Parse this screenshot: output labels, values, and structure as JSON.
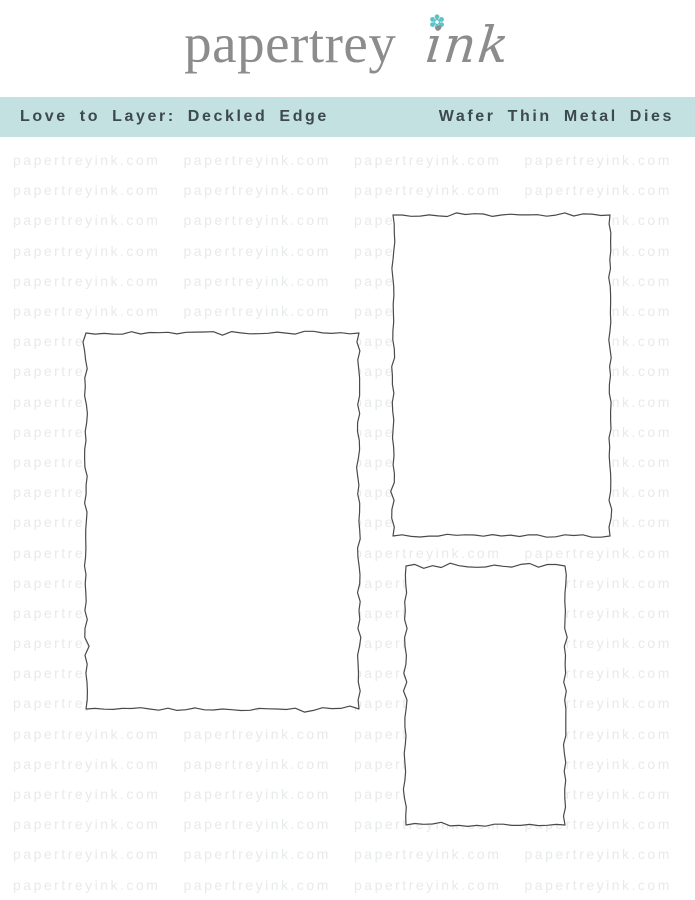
{
  "logo": {
    "brand_serif": "papertrey",
    "brand_script": "ink",
    "text_color": "#8c8c8c",
    "flower_icon_color": "#5cc3c6"
  },
  "banner": {
    "left_label": "Love to Layer: Deckled Edge",
    "right_label": "Wafer Thin Metal Dies",
    "background": "#c4e1e1",
    "text_color": "#3d4a4c"
  },
  "watermark": {
    "text": "papertreyink.com",
    "color": "#e7eaeb",
    "rows": 25,
    "columns": 4
  },
  "dies": {
    "stroke_color": "#4a4a4a",
    "fill_color": "#ffffff",
    "shapes": [
      {
        "name": "deckled-rectangle-die-large",
        "x": 83,
        "y": 330,
        "width": 279,
        "height": 382
      },
      {
        "name": "deckled-rectangle-die-medium",
        "x": 390,
        "y": 212,
        "width": 223,
        "height": 327
      },
      {
        "name": "deckled-rectangle-die-small",
        "x": 403,
        "y": 563,
        "width": 165,
        "height": 265
      }
    ]
  }
}
